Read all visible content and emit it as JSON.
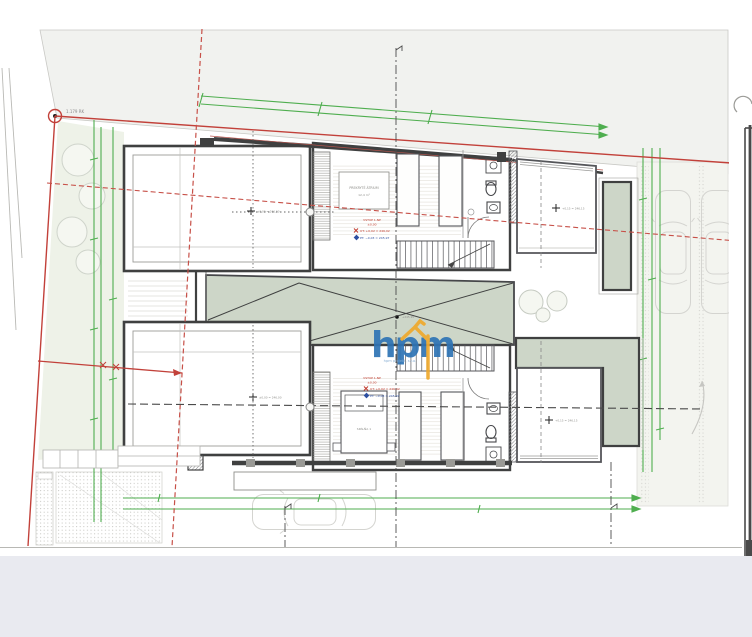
{
  "document": {
    "kind": "architectural site and floor plan drawing",
    "corner_point_label": "1.179 RK"
  },
  "watermark": {
    "text": "hpm",
    "tagline": "hpm projekt, s.r.o.",
    "blue": "#2e74b5",
    "yellow": "#efa92c"
  },
  "upper_unit": {
    "room_box_line1": "PREKRYTÉ ÁTRIUM",
    "room_box_line2": "12,4 m²",
    "annotation": [
      "VSTUP 1.NP",
      "±0,00",
      "UT: +0,02 = 246,02",
      "PT: −0,03 = 245,97"
    ],
    "left_room_level": "±0,00 = 246,00",
    "right_room_level": "+0,15 = 246,15"
  },
  "lower_unit": {
    "bed_label": "SPÁLŇA 1",
    "annotation": [
      "VSTUP 1.NP",
      "±0,00",
      "UT: +0,02 = 246,02",
      "PT: −0,03 = 245,97"
    ],
    "left_room_level": "±0,00 = 246,00",
    "right_room_level": "+0,15 = 246,15"
  },
  "courtyard": {
    "spot_level": "+245,95"
  },
  "palette": {
    "paper": "#ffffff",
    "road_gray": "#f1f2ef",
    "garden_green": "#eef2e8",
    "terrace_green": "#cdd6c8",
    "wall_dark": "#3f4040",
    "dimension_green": "#4fae4f",
    "boundary_red": "#c2413a",
    "footer_strip": "#e9eaf0",
    "logo_blue": "#2e74b5",
    "logo_yellow": "#efa92c"
  }
}
